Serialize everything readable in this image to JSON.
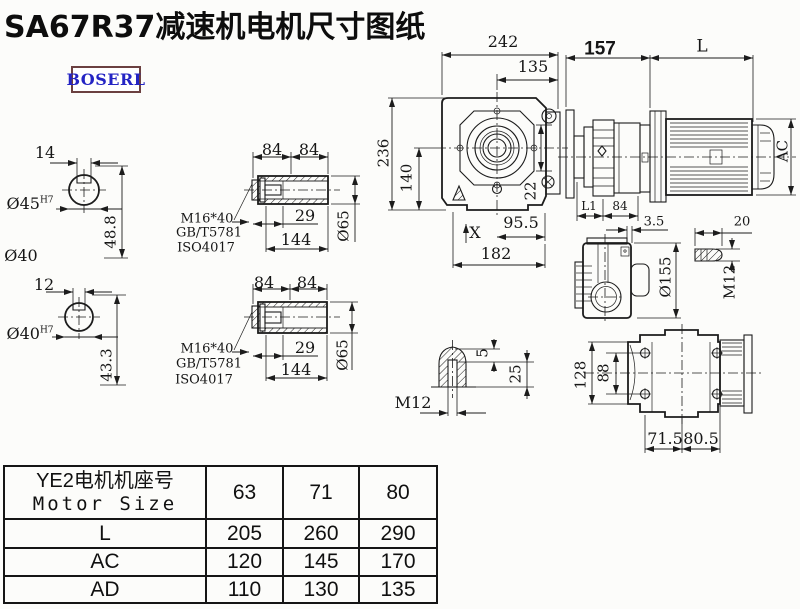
{
  "title": "SA67R37减速机电机尺寸图纸",
  "brand": {
    "logo_text": "BOSERL"
  },
  "colors": {
    "line": "#1c1c1c",
    "logo_text": "#2424c4",
    "logo_border": "#6b4040",
    "background": "#fcfcfa"
  },
  "views": {
    "shaft_end_1": {
      "key_width": "14",
      "bore_dia": "Ø45",
      "bore_tol": "H7",
      "depth": "48.8",
      "stub_dia": "Ø40"
    },
    "shaft_end_2": {
      "key_width": "12",
      "bore_dia": "Ø40",
      "bore_tol": "H7",
      "depth": "43.3"
    },
    "hollow_shaft_1": {
      "len_a": "84",
      "len_b": "84",
      "bolt": "M16*40",
      "std_gb": "GB/T5781",
      "std_iso": "ISO4017",
      "bore_len": "29",
      "total_len": "144",
      "outer_dia": "Ø65"
    },
    "hollow_shaft_2": {
      "len_a": "84",
      "len_b": "84",
      "bolt": "M16*40",
      "std_gb": "GB/T5781",
      "std_iso": "ISO4017",
      "bore_len": "29",
      "total_len": "144",
      "outer_dia": "Ø65"
    },
    "front_view": {
      "width": "242",
      "flange_offset": "135",
      "height": "236",
      "axis_height": "140",
      "lip": "22",
      "foot_a": "95.5",
      "base": "182",
      "mount_mark": "X"
    },
    "motor_view": {
      "stage_len": "157",
      "motor_len": "L",
      "motor_dia": "AC",
      "dim_l1": "L1",
      "dim_84": "84"
    },
    "input_side_view": {
      "lip_gap": "3.5",
      "housing_dia": "Ø155"
    },
    "stud_detail": {
      "length": "20",
      "thread": "M12"
    },
    "plug_detail": {
      "tip_depth": "5",
      "thread_depth": "25",
      "thread": "M12"
    },
    "rear_view": {
      "height": "128",
      "bolt_span": "88",
      "foot_a": "71.5",
      "foot_b": "80.5"
    }
  },
  "table": {
    "header_cn": "YE2电机机座号",
    "header_en": "Motor Size",
    "frame_sizes": [
      "63",
      "71",
      "80"
    ],
    "rows": [
      {
        "label": "L",
        "values": [
          "205",
          "260",
          "290"
        ]
      },
      {
        "label": "AC",
        "values": [
          "120",
          "145",
          "170"
        ]
      },
      {
        "label": "AD",
        "values": [
          "110",
          "130",
          "135"
        ]
      }
    ]
  }
}
